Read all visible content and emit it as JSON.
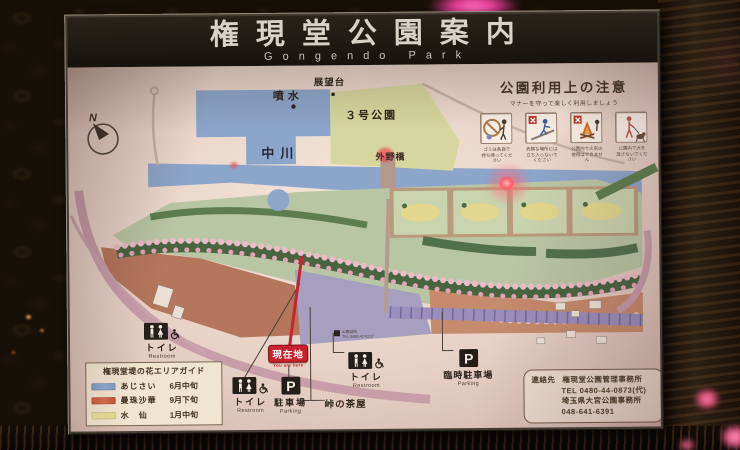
{
  "sign": {
    "title": "権現堂公園案内",
    "subtitle": "Gongendo Park"
  },
  "notice": {
    "title": "公園利用上の注意",
    "subtitle": "マナーを守って楽しく利用しましょう",
    "items": [
      {
        "icon": "no-littering-icon",
        "caption1": "ゴミは各自で",
        "caption2": "持ち帰ってください"
      },
      {
        "icon": "no-entry-danger-icon",
        "caption1": "危険な場所には",
        "caption2": "立ち入らないでください"
      },
      {
        "icon": "no-fire-icon",
        "caption1": "公園内で火気の",
        "caption2": "使用はできません"
      },
      {
        "icon": "dog-on-leash-icon",
        "caption1": "公園内で犬を",
        "caption2": "放さないでください"
      }
    ]
  },
  "map": {
    "compass_label": "N",
    "labels": {
      "fountain": "噴水",
      "observatory": "展望台",
      "park_no3": "３号公園",
      "river": "中川",
      "bridge": "外野橋"
    },
    "you_are_here": {
      "jp": "現在地",
      "en": "You are here"
    },
    "restroom": {
      "jp": "トイレ",
      "en": "Restroom"
    },
    "parking": {
      "jp": "駐車場",
      "en": "Parking",
      "p_symbol": "P"
    },
    "temp_parking": {
      "jp": "臨時駐車場",
      "en": "Parking"
    },
    "teahouse": "峠の茶屋",
    "office_note": {
      "line1": "公園詰所",
      "line2": "TEL.0480-42-0237"
    }
  },
  "legend": {
    "title": "権現堂堤の花エリアガイド",
    "items": [
      {
        "name": "あじさい",
        "season": "6月中旬",
        "color": "#7d9cc8"
      },
      {
        "name": "曼珠沙華",
        "season": "9月下旬",
        "color": "#cc5a40"
      },
      {
        "name": "水　仙",
        "season": "1月中旬",
        "color": "#e8dc9a"
      }
    ]
  },
  "contact": {
    "label": "連絡先",
    "office1": "権現堂公園管理事務所",
    "tel1": "TEL 0480-44-0873(代)",
    "office2": "埼玉県大宮公園事務所",
    "tel2": "048-641-6391"
  },
  "colors": {
    "board": "#ecd9cd",
    "header_band": "#211b16",
    "river_blue": "#8ca5ca",
    "park3_green": "#d6d79e",
    "strip_green": "#b9c6a4",
    "cherry_pink": "#eebcc8",
    "marker_red": "#c8232c",
    "road_purple": "#9a8eba",
    "terracotta": "#b4775c"
  }
}
